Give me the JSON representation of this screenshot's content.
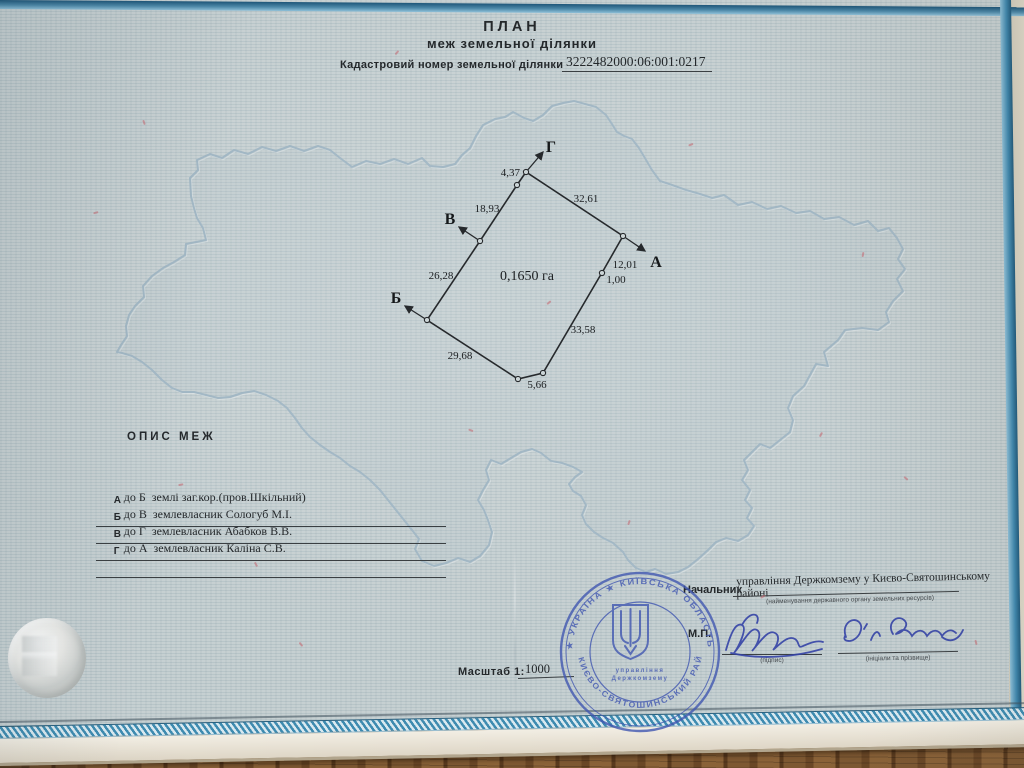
{
  "doc": {
    "title": "ПЛАН",
    "subtitle": "меж земельної ділянки",
    "cadastral_label": "Кадастровий номер земельної ділянки",
    "cadastral_number": "3222482000:06:001:0217"
  },
  "plot": {
    "area": "0,1650 га",
    "corner_a": "А",
    "corner_b": "Б",
    "corner_v": "В",
    "corner_g": "Г",
    "m_4_37": "4,37",
    "m_18_93": "18,93",
    "m_32_61": "32,61",
    "m_26_28": "26,28",
    "m_29_68": "29,68",
    "m_5_66": "5,66",
    "m_33_58": "33,58",
    "m_12_01": "12,01",
    "m_1_00": "1,00"
  },
  "opys": {
    "heading": "ОПИС МЕЖ",
    "rows": [
      {
        "corner": "А",
        "text": "до Б  землі заг.кор.(пров.Шкільний)"
      },
      {
        "corner": "Б",
        "text": "до В  землевласник Сологуб М.І."
      },
      {
        "corner": "В",
        "text": "до Г  землевласник Абабков В.В."
      },
      {
        "corner": "Г",
        "text": "до А  землевласник Каліна С.В."
      }
    ]
  },
  "officials": {
    "role": "Начальник",
    "org": "управління Держкомзему у Києво-Святошинському районі",
    "org_caption": "(найменування державного органу земельних ресурсів)",
    "mp": "М.П.",
    "sig_caption": "(підпис)",
    "name_caption": "(ініціали та прізвище)"
  },
  "scale": {
    "label": "Масштаб 1:",
    "value": "1000"
  },
  "stamp": {
    "ring_top": "★ УКРАЇНА ★ КИЇВСЬКА ОБЛАСТЬ",
    "ring_bottom": "КИЄВО-СВЯТОШИНСЬКИЙ РАЙОН",
    "center_line1": "управління",
    "center_line2": "Держкомзему"
  },
  "colors": {
    "stamp_blue": "#4056b0",
    "ink_blue": "#3442a6",
    "band_teal": "#3e8bb0",
    "paper": "#bfc9cb"
  }
}
